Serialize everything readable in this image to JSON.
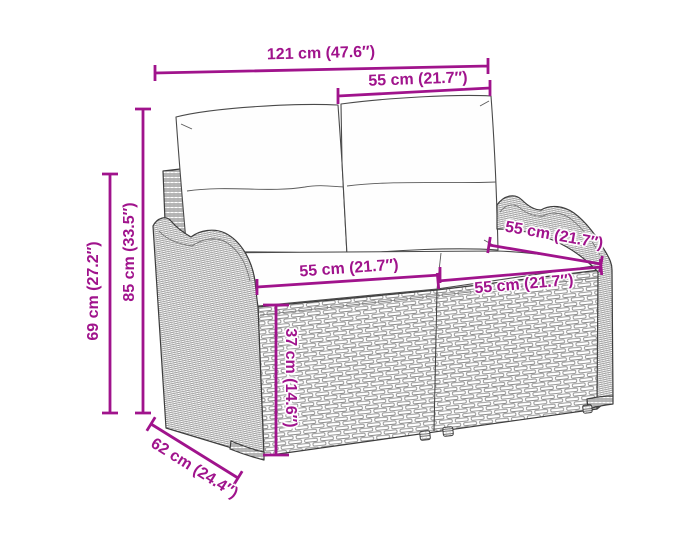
{
  "meta": {
    "accent_color": "#A0138C",
    "background_color": "#ffffff",
    "illustration": "poly-rattan-2-seater-garden-bench-with-cushions-dimension-diagram"
  },
  "diagram": {
    "dimensions": {
      "total_width": {
        "label": "121 cm (47.6″)",
        "orientation": "horizontal-top"
      },
      "section_width_top": {
        "label": "55 cm (21.7″)",
        "orientation": "horizontal-top"
      },
      "total_height": {
        "label": "85 cm (33.5″)",
        "orientation": "vertical-left"
      },
      "side_height": {
        "label": "69 cm (27.2″)",
        "orientation": "vertical-left"
      },
      "seat_width_left": {
        "label": "55 cm (21.7″)",
        "orientation": "horizontal-middle"
      },
      "seat_height": {
        "label": "37 cm (14.6″)",
        "orientation": "vertical-middle"
      },
      "seat_depth": {
        "label": "55 cm (21.7″)",
        "orientation": "diagonal-right"
      },
      "seat_width_right": {
        "label": "55 cm (21.7″)",
        "orientation": "horizontal-right"
      },
      "base_depth": {
        "label": "62 cm (24.4″)",
        "orientation": "diagonal-bottom-left"
      }
    }
  }
}
